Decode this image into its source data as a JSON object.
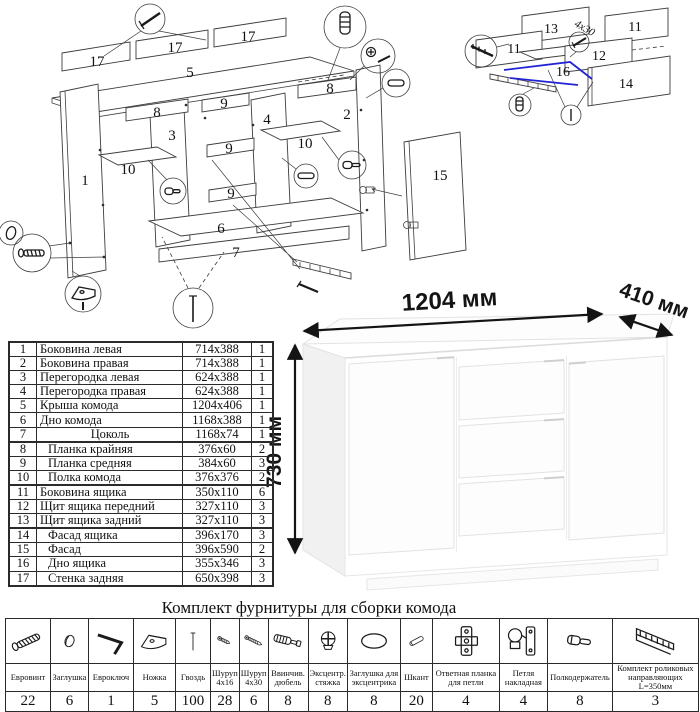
{
  "main_diagram": {
    "part_labels": [
      {
        "t": "17",
        "x": 97,
        "y": 66
      },
      {
        "t": "17",
        "x": 175,
        "y": 52
      },
      {
        "t": "17",
        "x": 248,
        "y": 41
      },
      {
        "t": "5",
        "x": 190,
        "y": 77
      },
      {
        "t": "8",
        "x": 157,
        "y": 117
      },
      {
        "t": "8",
        "x": 330,
        "y": 93
      },
      {
        "t": "3",
        "x": 172,
        "y": 140
      },
      {
        "t": "4",
        "x": 267,
        "y": 124
      },
      {
        "t": "9",
        "x": 224,
        "y": 108
      },
      {
        "t": "9",
        "x": 229,
        "y": 153
      },
      {
        "t": "9",
        "x": 231,
        "y": 198
      },
      {
        "t": "2",
        "x": 347,
        "y": 119
      },
      {
        "t": "10",
        "x": 128,
        "y": 174
      },
      {
        "t": "10",
        "x": 305,
        "y": 148
      },
      {
        "t": "1",
        "x": 85,
        "y": 185
      },
      {
        "t": "6",
        "x": 221,
        "y": 233
      },
      {
        "t": "7",
        "x": 236,
        "y": 257
      },
      {
        "t": "15",
        "x": 440,
        "y": 180
      }
    ],
    "callout_icons": [
      "nail-icon",
      "dowel-screw-icon",
      "cam-icon",
      "dowel-icon",
      "shelf-pin-icon",
      "dowel-icon",
      "shelf-pin-icon",
      "cap-icon",
      "confirmat-icon",
      "foot-icon",
      "nail-icon"
    ]
  },
  "drawer_diagram": {
    "part_labels": [
      {
        "t": "13",
        "x": 99,
        "y": 33
      },
      {
        "t": "11",
        "x": 62,
        "y": 53
      },
      {
        "t": "11",
        "x": 183,
        "y": 31
      },
      {
        "t": "12",
        "x": 147,
        "y": 60
      },
      {
        "t": "16",
        "x": 111,
        "y": 76
      },
      {
        "t": "14",
        "x": 174,
        "y": 88
      }
    ],
    "screw_note": "4x30",
    "callout_icons": [
      "slide-icon",
      "screw-small-icon",
      "dowel-screw-icon",
      "nail-icon"
    ]
  },
  "product": {
    "width_label": "1204 мм",
    "depth_label": "410 мм",
    "height_label": "730 мм"
  },
  "parts_table": {
    "rows": [
      {
        "num": 1,
        "name": "Боковина левая",
        "size": "714x388",
        "qty": 1
      },
      {
        "num": 2,
        "name": "Боковина правая",
        "size": "714x388",
        "qty": 1
      },
      {
        "num": 3,
        "name": "Перегородка левая",
        "size": "624x388",
        "qty": 1
      },
      {
        "num": 4,
        "name": "Перегородка правая",
        "size": "624x388",
        "qty": 1
      },
      {
        "num": 5,
        "name": "Крыша комода",
        "size": "1204x406",
        "qty": 1
      },
      {
        "num": 6,
        "name": "Дно комода",
        "size": "1168x388",
        "qty": 1
      },
      {
        "num": 7,
        "name": "Цоколь",
        "size": "1168x74",
        "qty": 1
      },
      {
        "num": 8,
        "name": "Планка крайняя",
        "size": "376x60",
        "qty": 2
      },
      {
        "num": 9,
        "name": "Планка средняя",
        "size": "384x60",
        "qty": 3
      },
      {
        "num": 10,
        "name": "Полка комода",
        "size": "376x376",
        "qty": 2
      },
      {
        "num": 11,
        "name": "Боковина ящика",
        "size": "350x110",
        "qty": 6
      },
      {
        "num": 12,
        "name": "Щит ящика передний",
        "size": "327x110",
        "qty": 3
      },
      {
        "num": 13,
        "name": "Щит ящика задний",
        "size": "327x110",
        "qty": 3
      },
      {
        "num": 14,
        "name": "Фасад ящика",
        "size": "396x170",
        "qty": 3
      },
      {
        "num": 15,
        "name": "Фасад",
        "size": "396x590",
        "qty": 2
      },
      {
        "num": 16,
        "name": "Дно ящика",
        "size": "355x346",
        "qty": 3
      },
      {
        "num": 17,
        "name": "Стенка задняя",
        "size": "650x398",
        "qty": 3
      }
    ]
  },
  "hardware": {
    "title": "Комплект фурнитуры для сборки комода",
    "items": [
      {
        "name": "Евровинт",
        "qty": 22,
        "icon": "confirmat-icon"
      },
      {
        "name": "Заглушка",
        "qty": 6,
        "icon": "cap-icon"
      },
      {
        "name": "Евроключ",
        "qty": 1,
        "icon": "hexkey-icon"
      },
      {
        "name": "Ножка",
        "qty": 5,
        "icon": "foot-icon"
      },
      {
        "name": "Гвоздь",
        "qty": 100,
        "icon": "nail-icon"
      },
      {
        "name": "Шуруп 4x16",
        "qty": 28,
        "icon": "screw-small-icon"
      },
      {
        "name": "Шуруп 4x30",
        "qty": 6,
        "icon": "screw-long-icon"
      },
      {
        "name": "Ввинчив. дюбель",
        "qty": 8,
        "icon": "dowel-screw-icon"
      },
      {
        "name": "Эксцентр. стяжка",
        "qty": 8,
        "icon": "cam-icon"
      },
      {
        "name": "Заглушка для эксцентрика",
        "qty": 8,
        "icon": "oval-cap-icon"
      },
      {
        "name": "Шкант",
        "qty": 20,
        "icon": "dowel-icon"
      },
      {
        "name": "Ответная планка для петли",
        "qty": 4,
        "icon": "plate-icon"
      },
      {
        "name": "Петля накладная",
        "qty": 4,
        "icon": "hinge-icon"
      },
      {
        "name": "Полкодержатель",
        "qty": 8,
        "icon": "shelf-pin-icon"
      },
      {
        "name": "Комплект роликовых направляющих L=350мм",
        "qty": 3,
        "icon": "slide-icon"
      }
    ]
  }
}
